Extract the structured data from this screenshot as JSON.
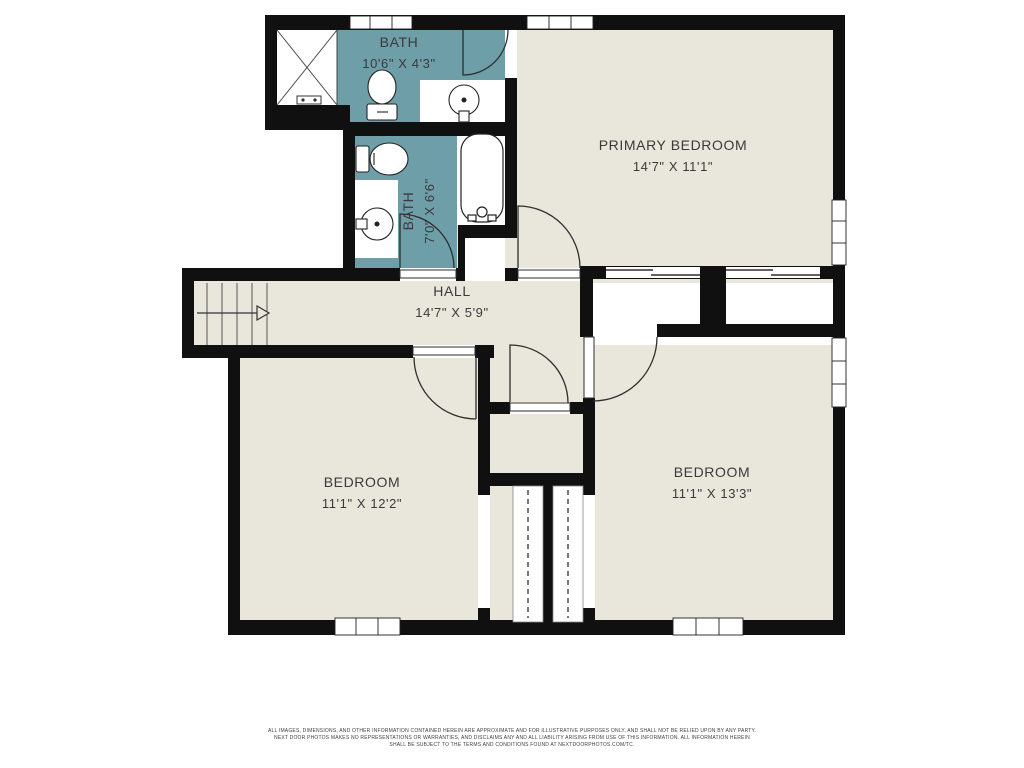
{
  "plan": {
    "colors": {
      "wall": "#101010",
      "floor": "#e9e6dc",
      "bath_floor": "#6e9ea8",
      "line": "#2e2e2e"
    },
    "rooms": [
      {
        "id": "bath-top",
        "name": "BATH",
        "dims": "10'6\" X 4'3\""
      },
      {
        "id": "primary-bedroom",
        "name": "PRIMARY BEDROOM",
        "dims": "14'7\" X 11'1\""
      },
      {
        "id": "bath-lower",
        "name": "BATH",
        "dims": "7'0\" X 6'6\""
      },
      {
        "id": "hall",
        "name": "HALL",
        "dims": "14'7\" X 5'9\""
      },
      {
        "id": "bedroom-left",
        "name": "BEDROOM",
        "dims": "11'1\" X 12'2\""
      },
      {
        "id": "bedroom-right",
        "name": "BEDROOM",
        "dims": "11'1\" X 13'3\""
      }
    ],
    "fixtures": [
      "shower",
      "toilet",
      "sink",
      "toilet",
      "sink",
      "bathtub",
      "stairs",
      "closet-rod",
      "closet-rod",
      "sliding-doors"
    ]
  },
  "disclaimer": {
    "line1": "ALL IMAGES, DIMENSIONS, AND OTHER INFORMATION CONTAINED HEREIN ARE APPROXIMATE AND FOR ILLUSTRATIVE PURPOSES ONLY, AND SHALL NOT BE RELIED UPON BY ANY PARTY.",
    "line2": "NEXT DOOR PHOTOS MAKES NO REPRESENTATIONS OR WARRANTIES, AND DISCLAIMS ANY AND ALL LIABILITY ARISING FROM USE OF THIS INFORMATION. ALL INFORMATION HEREIN",
    "line3": "SHALL BE SUBJECT TO THE TERMS AND CONDITIONS FOUND AT NEXTDOORPHOTOS.COM/TC."
  }
}
